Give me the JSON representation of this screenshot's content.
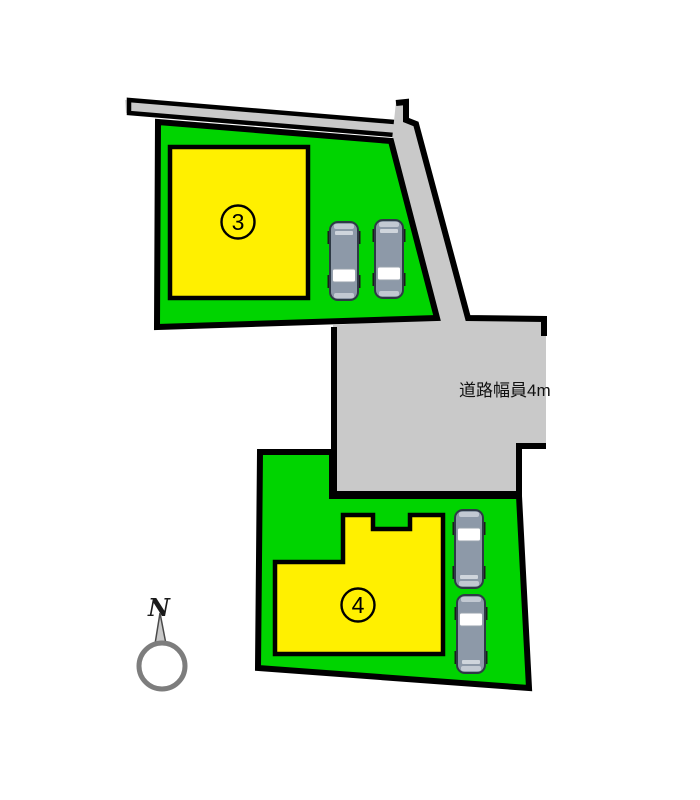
{
  "diagram": {
    "road": {
      "label": "道路幅員4m"
    },
    "lots": [
      {
        "number": "3",
        "parked_cars": 2
      },
      {
        "number": "4",
        "parked_cars": 2
      }
    ],
    "compass": {
      "label": "N"
    },
    "colors": {
      "land": "#00D400",
      "building": "#FFF000",
      "road": "#C9C9C9",
      "outline": "#000000",
      "car_body": "#8D99A8",
      "car_windshield": "#FFFFFF"
    }
  }
}
